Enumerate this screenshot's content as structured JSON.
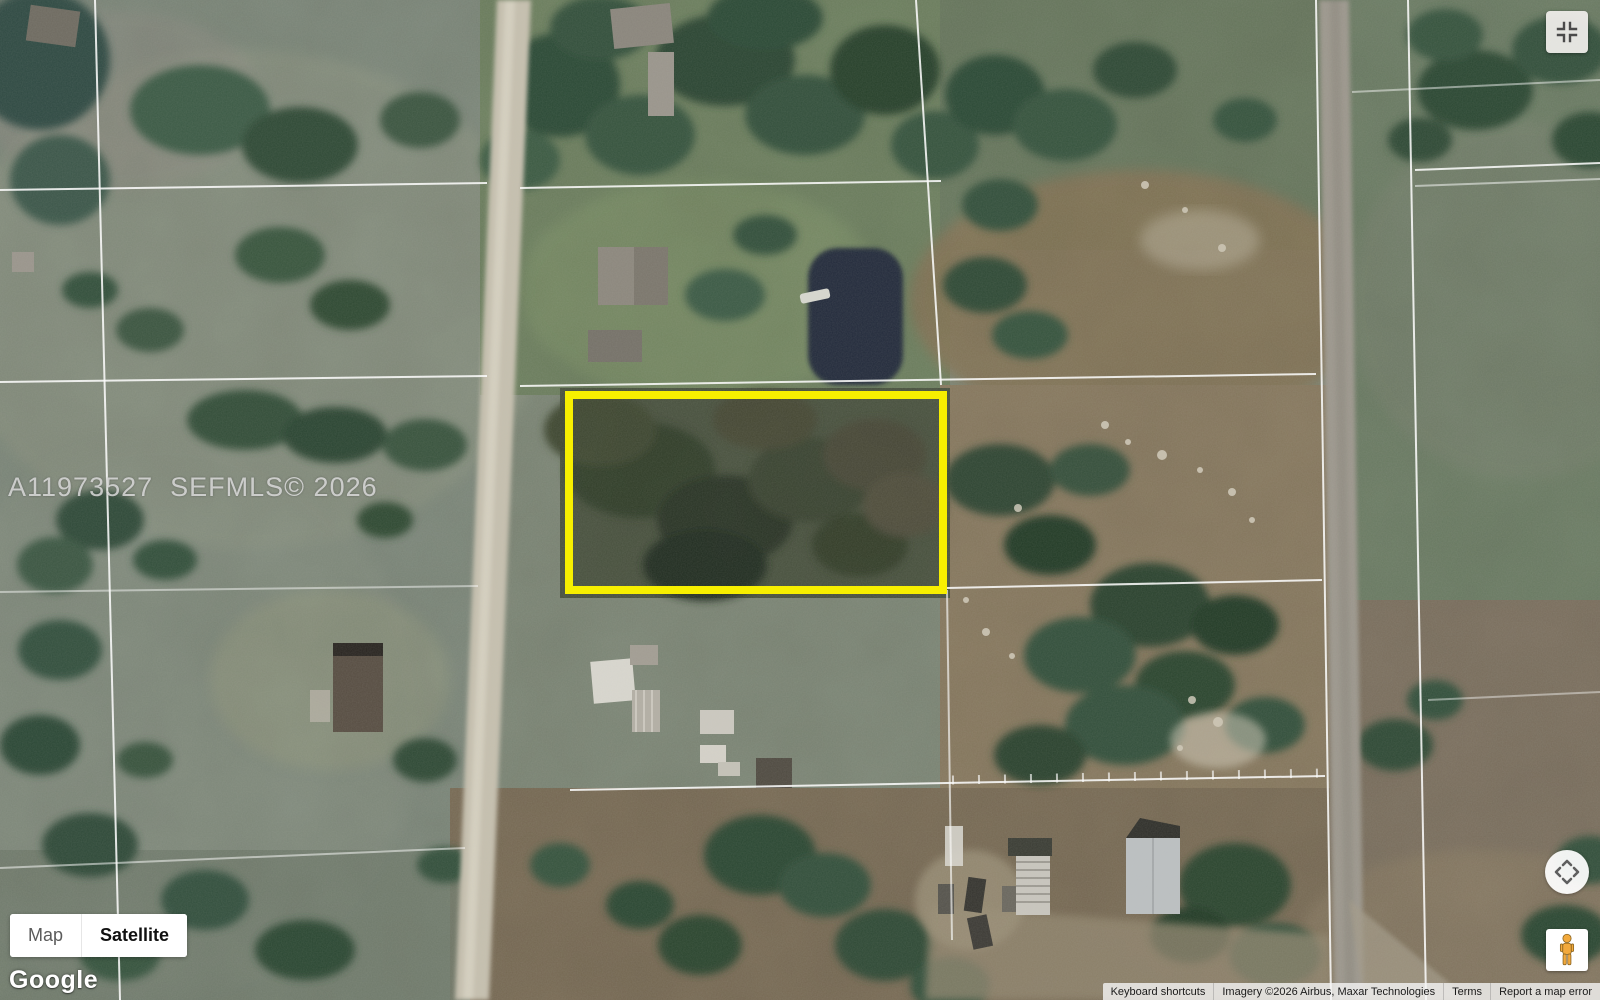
{
  "watermark": {
    "text": "A11973527  SEFMLS© 2026"
  },
  "map_type_control": {
    "map_label": "Map",
    "satellite_label": "Satellite",
    "selected": "Satellite"
  },
  "google_logo": {
    "text": "Google"
  },
  "attribution": {
    "keyboard_shortcuts": "Keyboard shortcuts",
    "imagery": "Imagery ©2026 Airbus, Maxar Technologies",
    "terms": "Terms",
    "report_error": "Report a map error"
  },
  "icons": {
    "fullscreen": "fullscreen-exit-icon",
    "pan": "pan-arrows-icon",
    "pegman": "pegman-street-view-icon"
  },
  "accent_colors": {
    "parcel_highlight": "#f7ef00",
    "pegman_yellow": "#f2a93c",
    "pond_water": "#202c3a"
  }
}
